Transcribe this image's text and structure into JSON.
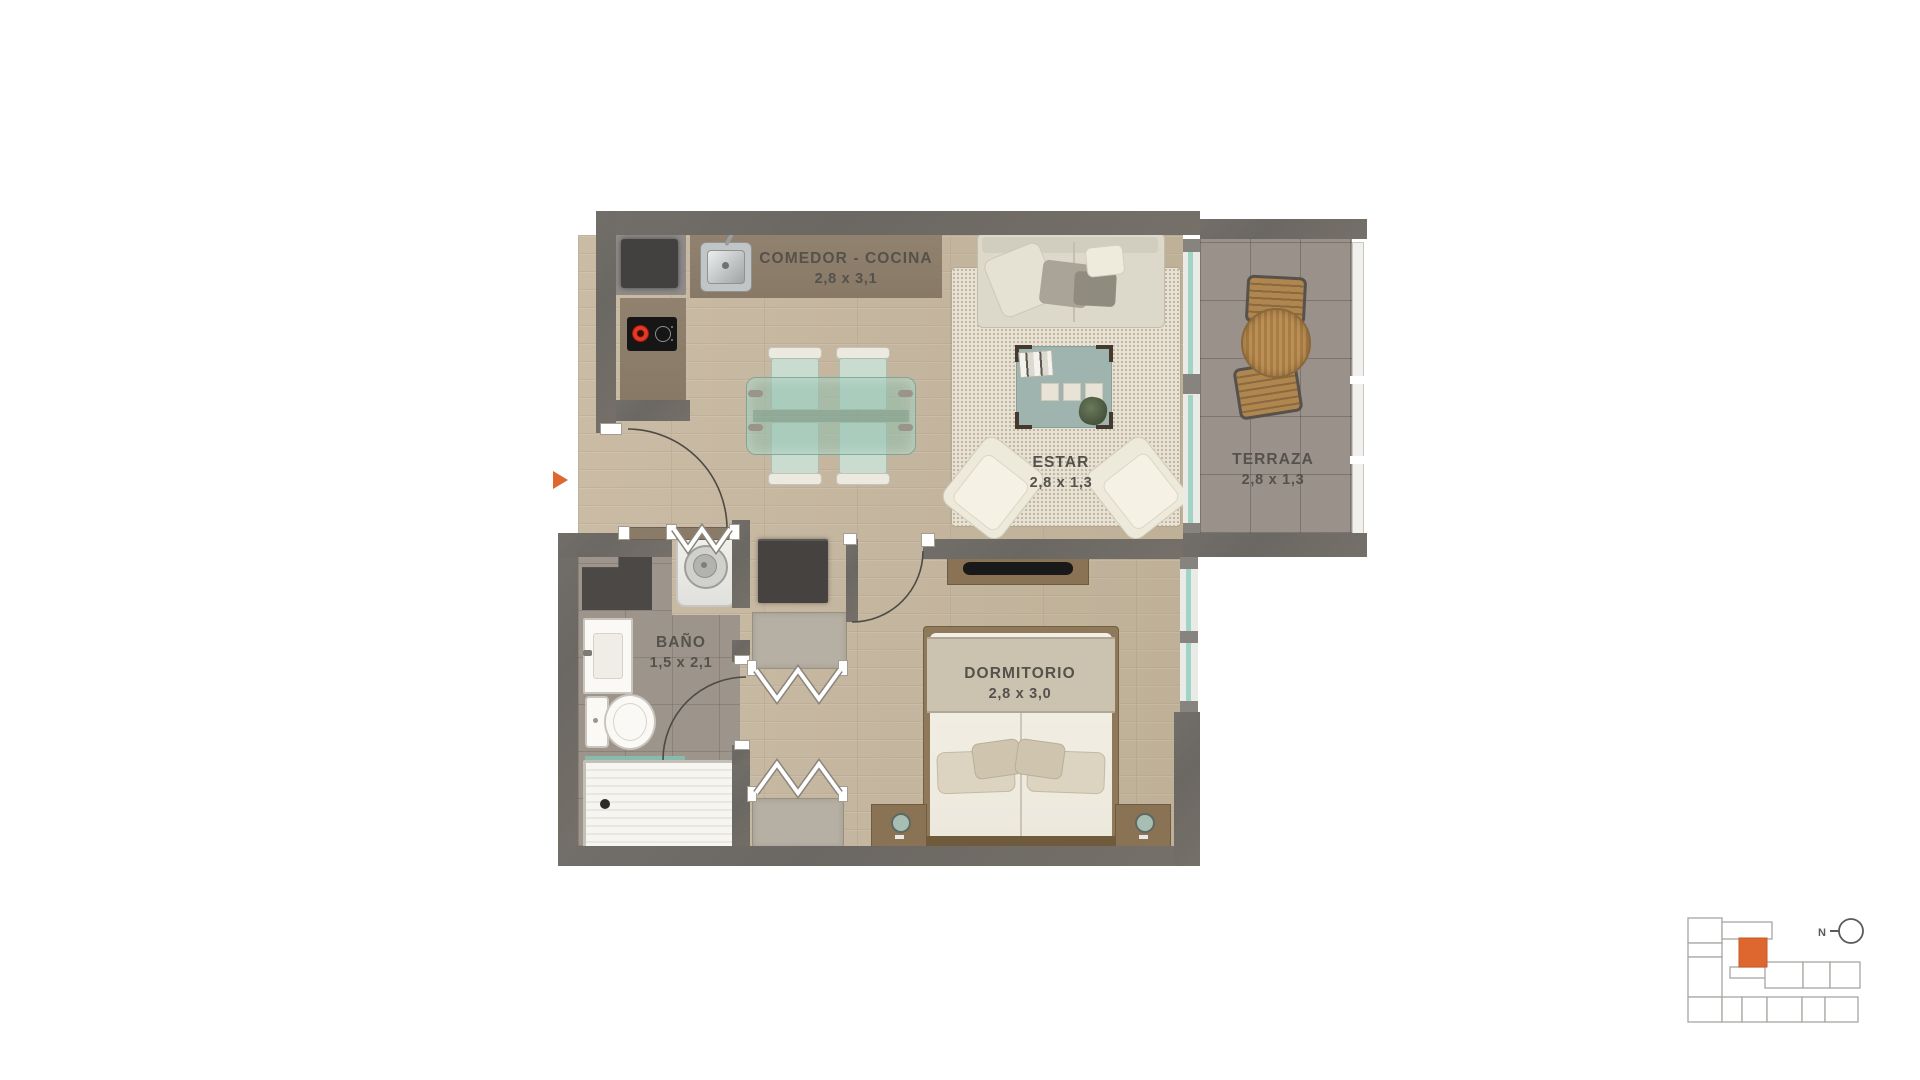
{
  "floor_plan": {
    "rooms": [
      {
        "name": "COMEDOR - COCINA",
        "dimensions": "2,8 x 3,1"
      },
      {
        "name": "ESTAR",
        "dimensions": "2,8 x 1,3"
      },
      {
        "name": "TERRAZA",
        "dimensions": "2,8 x 1,3"
      },
      {
        "name": "BAÑO",
        "dimensions": "1,5 x 2,1"
      },
      {
        "name": "DORMITORIO",
        "dimensions": "2,8 x 3,0"
      }
    ],
    "entrance_marker_color": "#dd672e"
  },
  "key_plan": {
    "compass_label": "N",
    "highlight_color": "#dd672e"
  },
  "colors": {
    "wall": "#6f6b66",
    "wood_floor": "#c6b7a1",
    "bath_tile": "#9d948b",
    "terrace_tile": "#99918a",
    "counter": "#8d7d6b",
    "label_text": "#55514b",
    "accent_orange": "#dd672e",
    "glass": "#9fd4c6"
  }
}
